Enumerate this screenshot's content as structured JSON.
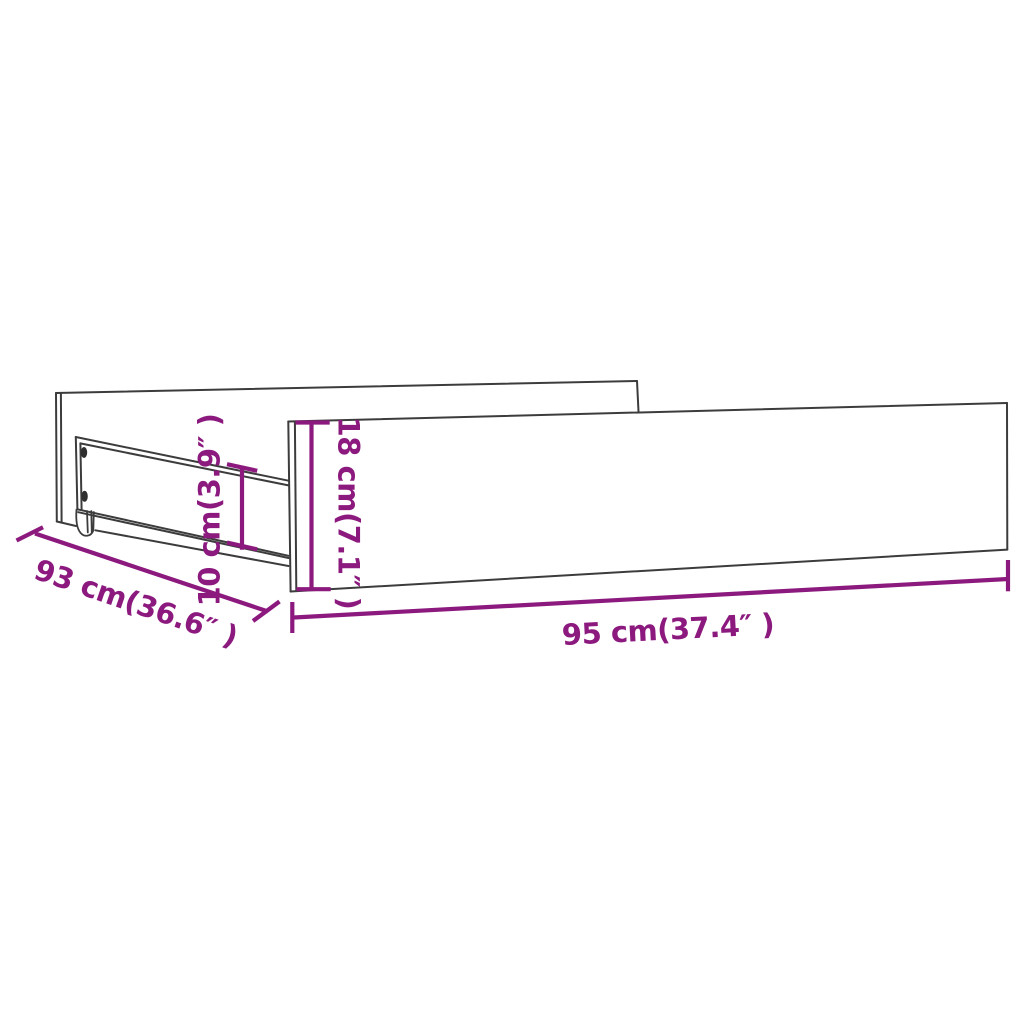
{
  "diagram": {
    "subject": "drawer-line-drawing",
    "background_color": "#FFFFFF",
    "outline_color": "#3C3C3C",
    "accent_color": "#8C1A7E",
    "dimensions": [
      {
        "id": "length-bottom",
        "label": "95 cm(37.4″ )",
        "value_cm": "95",
        "value_inch": "37.4"
      },
      {
        "id": "depth-diagonal",
        "label": "93 cm(36.6″ )",
        "value_cm": "93",
        "value_inch": "36.6"
      },
      {
        "id": "front-panel-height",
        "label": "18 cm(7.1″ )",
        "value_cm": "18",
        "value_inch": "7.1"
      },
      {
        "id": "side-rail-height",
        "label": "10 cm(3.9″ )",
        "value_cm": "10",
        "value_inch": "3.9"
      }
    ]
  }
}
